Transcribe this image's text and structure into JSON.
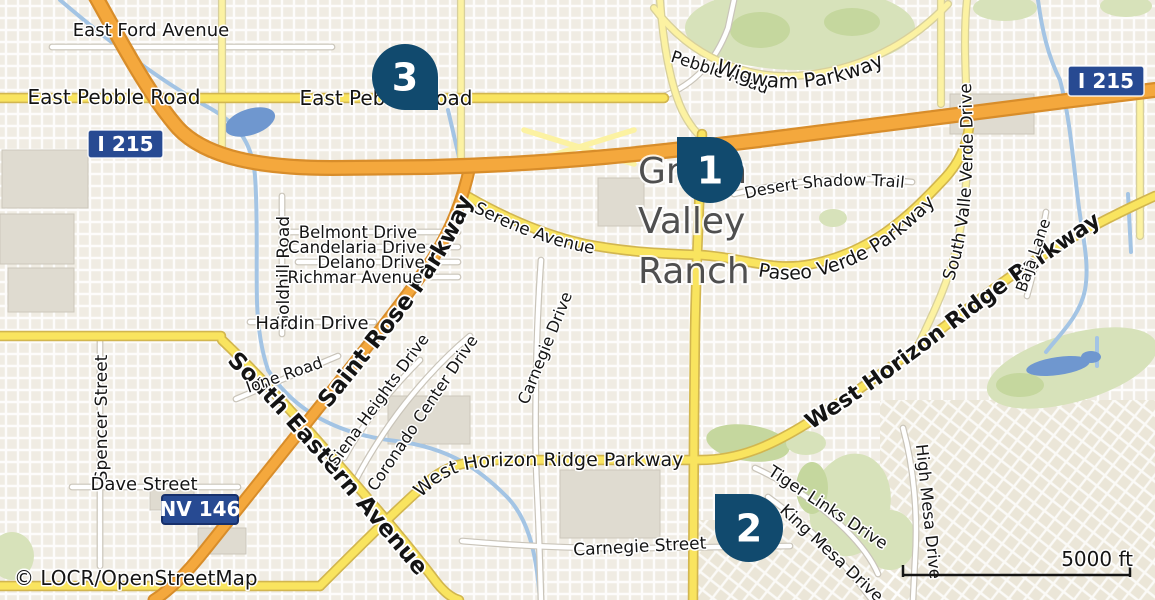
{
  "map": {
    "attribution": "© LOCR/OpenStreetMap",
    "scale": {
      "label": "5000 ft"
    },
    "place": {
      "name": "Green Valley Ranch",
      "lines": [
        "Green",
        "Valley",
        "Ranch"
      ]
    },
    "shields": {
      "i215": "I 215",
      "nv146": "NV 146"
    },
    "marker_color": "#114a6e",
    "markers": [
      {
        "number": "1",
        "cx": 710,
        "cy": 170,
        "r": 33,
        "tip": "nw"
      },
      {
        "number": "2",
        "cx": 749,
        "cy": 528,
        "r": 34,
        "tip": "nw"
      },
      {
        "number": "3",
        "cx": 405,
        "cy": 77,
        "r": 33,
        "tip": "se"
      }
    ],
    "road_labels": {
      "east_ford": "East Ford Avenue",
      "east_pebble_w": "East Pebble Road",
      "east_pebble_e": "East Pebble Road",
      "pebble": "Pebble Road",
      "wigwam": "Wigwam Parkway",
      "desert_shadow": "Desert Shadow Trail",
      "paseo_verde": "Paseo Verde Parkway",
      "serene": "Serene Avenue",
      "saint_rose": "Saint Rose Parkway",
      "south_eastern": "South Eastern Avenue",
      "goldhill": "Goldhill Road",
      "belmont": "Belmont Drive",
      "candelaria": "Candelaria Drive",
      "delano": "Delano Drive",
      "richmar": "Richmar Avenue",
      "hardin": "Hardin Drive",
      "ione": "Ione Road",
      "spencer": "Spencer Street",
      "dave": "Dave Street",
      "siena": "Siena Heights Drive",
      "coronado": "Coronado Center Drive",
      "carnegie_drive": "Carnegie Drive",
      "carnegie_street": "Carnegie Street",
      "horizon_center": "West Horizon Ridge Parkway",
      "horizon_bold": "West Horizon Ridge Parkway",
      "valle_verde": "South Valle Verde Drive",
      "baja": "Baja Lane",
      "tiger_links": "Tiger Links Drive",
      "king_mesa": "King Mesa Drive",
      "high_mesa": "High Mesa Drive"
    },
    "colors": {
      "background": "#f0ece3",
      "motorway": "#f4a83d",
      "arterial": "#f9e45f",
      "collector": "#fcf2a2",
      "golf_green": "#d7e2ba",
      "water": "#a3c4e4",
      "shield_blue": "#274a92",
      "marker_navy": "#114a6e"
    }
  }
}
